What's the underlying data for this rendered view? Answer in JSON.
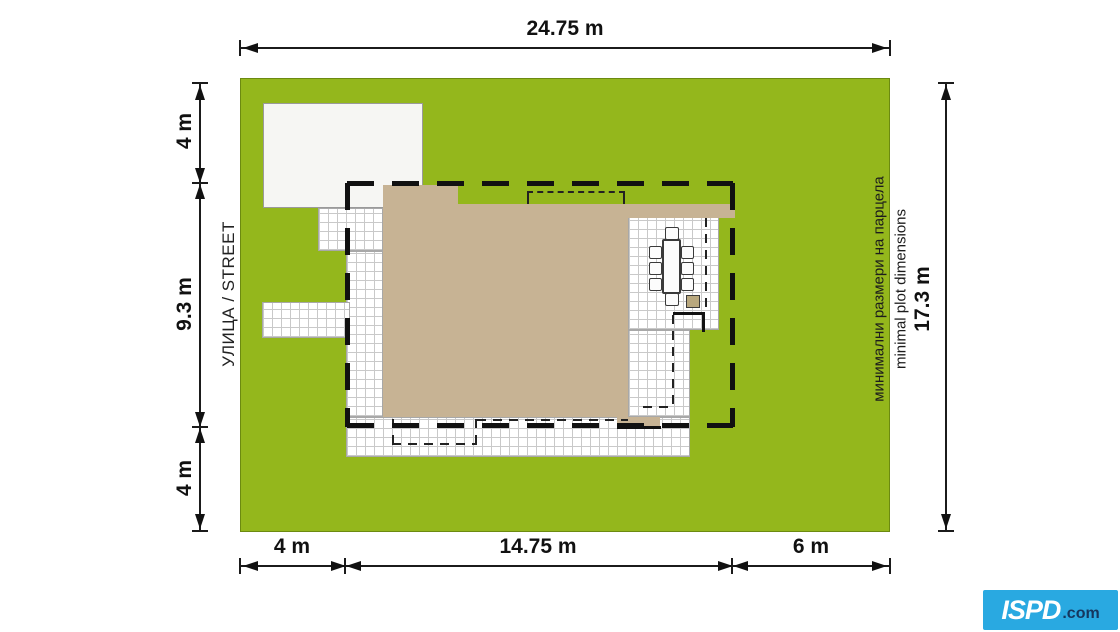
{
  "plan": {
    "street_label": "УЛИЦА / STREET",
    "note_bg": "минимални размери на парцела",
    "note_en": "minimal plot dimensions",
    "dim_top": "24.75 m",
    "dim_right": "17.3 m",
    "dim_left": {
      "top": "4 m",
      "mid": "9.3 m",
      "bottom": "4 m"
    },
    "dim_bottom": {
      "left": "4 m",
      "mid": "14.75 m",
      "right": "6 m"
    },
    "colors": {
      "grass": "#94b71c",
      "roof": "#c7b394",
      "paving": "#ffffff",
      "paving_grid": "#c9c9c9",
      "setback_dash": "#111111",
      "garage": "#f6f6f3"
    }
  },
  "logo": {
    "brand": "ISPD",
    "suffix": ".com",
    "bg_color": "#29a9e1",
    "suffix_color": "#15375f"
  }
}
